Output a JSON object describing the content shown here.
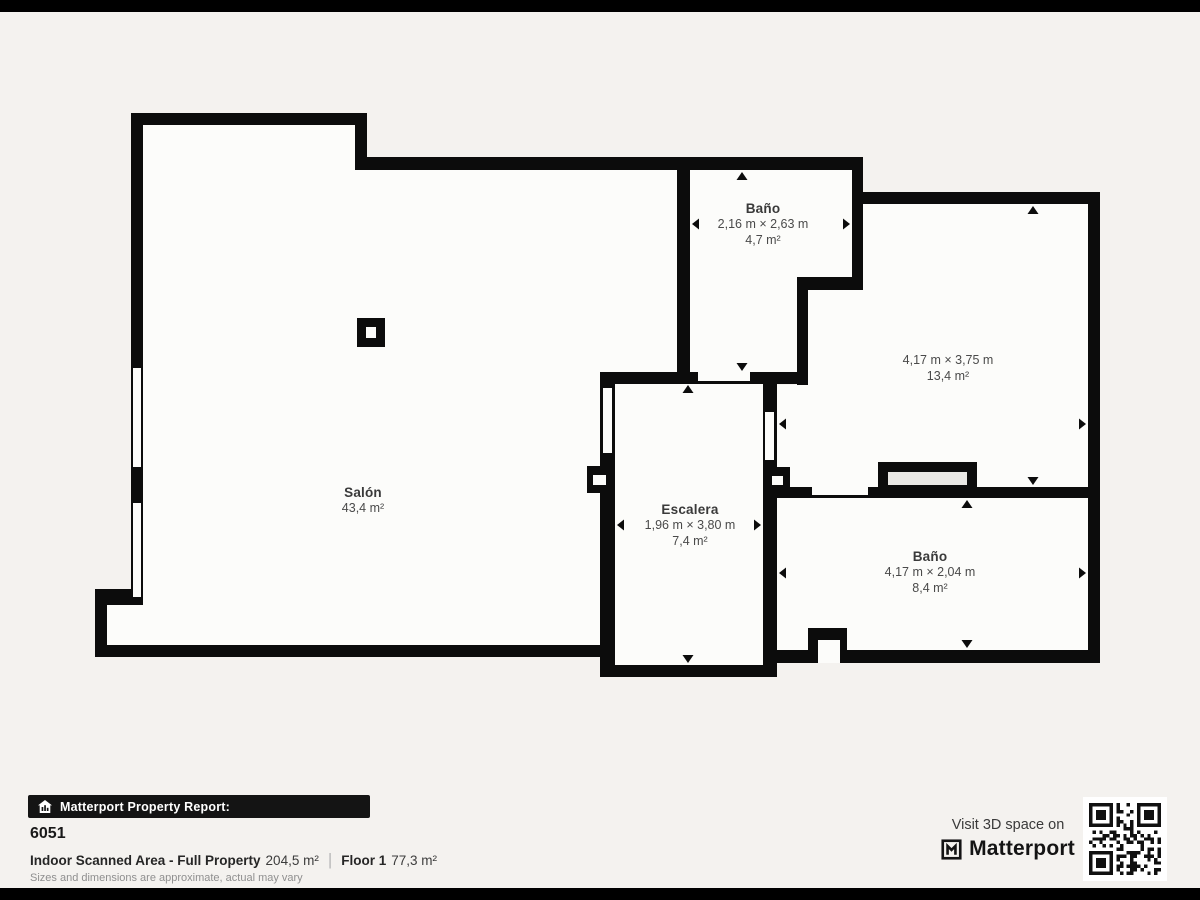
{
  "rooms": [
    {
      "id": "salon",
      "name": "Salón",
      "dims": "",
      "area": "43,4 m²"
    },
    {
      "id": "bano-top",
      "name": "Baño",
      "dims": "2,16 m × 2,63 m",
      "area": "4,7 m²"
    },
    {
      "id": "room-right",
      "name": "",
      "dims": "4,17 m × 3,75 m",
      "area": "13,4 m²"
    },
    {
      "id": "escalera",
      "name": "Escalera",
      "dims": "1,96 m × 3,80 m",
      "area": "7,4 m²"
    },
    {
      "id": "bano-bottom",
      "name": "Baño",
      "dims": "4,17 m × 2,04 m",
      "area": "8,4 m²"
    }
  ],
  "footer": {
    "badge_label": "Matterport Property Report:",
    "property_id": "6051",
    "scanned_area_label": "Indoor Scanned Area - Full Property",
    "scanned_area_value": "204,5 m²",
    "floor_label": "Floor 1",
    "floor_value": "77,3 m²",
    "disclaimer": "Sizes and dimensions are approximate, actual may vary",
    "visit_text": "Visit 3D space on",
    "brand": "Matterport"
  },
  "icons": {
    "badge_icon": "house-chart-icon",
    "brand_icon": "matterport-m-icon",
    "qr_icon": "qr-code"
  },
  "colors": {
    "background": "#f4f2ef",
    "wall": "#0c0c0c",
    "floor": "#fcfcfa",
    "fixture_fill": "#e9e8e5",
    "letterbox": "#000000"
  }
}
